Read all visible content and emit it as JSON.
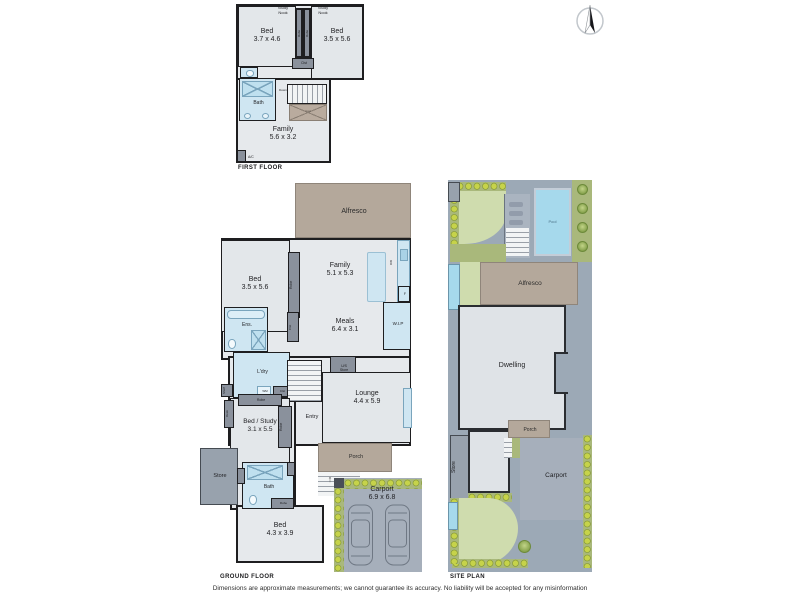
{
  "plan_labels": {
    "first_floor": "FIRST FLOOR",
    "ground_floor": "GROUND FLOOR",
    "site_plan": "SITE PLAN"
  },
  "disclaimer": "Dimensions are approximate measurements; we cannot guarantee its accuracy. No liability will be accepted for any misinformation",
  "first_floor": {
    "study_nook_left": "Study\nNook",
    "study_nook_right": "Study\nNook",
    "bed_left_name": "Bed",
    "bed_left_dims": "3.7 x 4.6",
    "bed_right_name": "Bed",
    "bed_right_dims": "3.5 x 5.6",
    "robe_left": "Robe",
    "robe_right": "Robe",
    "clst": "Clst",
    "bath": "Bath",
    "down": "Down",
    "void": "Void",
    "family_name": "Family",
    "family_dims": "5.6 x 3.2",
    "ac": "A/C"
  },
  "ground_floor": {
    "alfresco": "Alfresco",
    "bed1_name": "Bed",
    "bed1_dims": "3.5 x 5.6",
    "family_name": "Family",
    "family_dims": "5.1 x 5.3",
    "robe1": "Robe",
    "dw": "DW",
    "fridge": "F",
    "meals_name": "Meals",
    "meals_dims": "6.4 x 3.1",
    "wip": "W.I.P",
    "ens": "Ens.",
    "clst_vert": "Clst",
    "ldry": "L'dry",
    "wm": "WM",
    "cupd": "Clst",
    "shelf": "Shelf",
    "us_store": "U/S\nStore",
    "lounge_name": "Lounge",
    "lounge_dims": "4.4 x 5.9",
    "entry": "Entry",
    "bed_study_name": "Bed / Study",
    "bed_study_dims": "3.1 x 5.5",
    "desk": "Desk",
    "robe_h": "Robe",
    "robe_v": "Robe",
    "robe_bath": "Robe",
    "store": "Store",
    "bath": "Bath",
    "bed2_name": "Bed",
    "bed2_dims": "4.3 x 3.9",
    "porch": "Porch",
    "carport_name": "Carport",
    "carport_dims": "6.9 x 6.8"
  },
  "site_plan": {
    "pool": "Pool",
    "alfresco": "Alfresco",
    "dwelling": "Dwelling",
    "store": "Store",
    "porch": "Porch",
    "carport": "Carport"
  },
  "colors": {
    "wall": "#1e1e20",
    "room_fill": "#e3e7ea",
    "wet_area_blue": "#cfe6f2",
    "alfresco_tan": "#b4a89b",
    "cabinet_gray": "#8a919c",
    "store_gray": "#98a2ad",
    "site_base_gray": "#9ca9b6",
    "lawn_green": "#cfdcae",
    "garden_olive": "#a9b87b",
    "hedge_green": "#c6d34a",
    "pool_blue": "#a6d9ec",
    "carport_gray": "#a6afbb"
  }
}
